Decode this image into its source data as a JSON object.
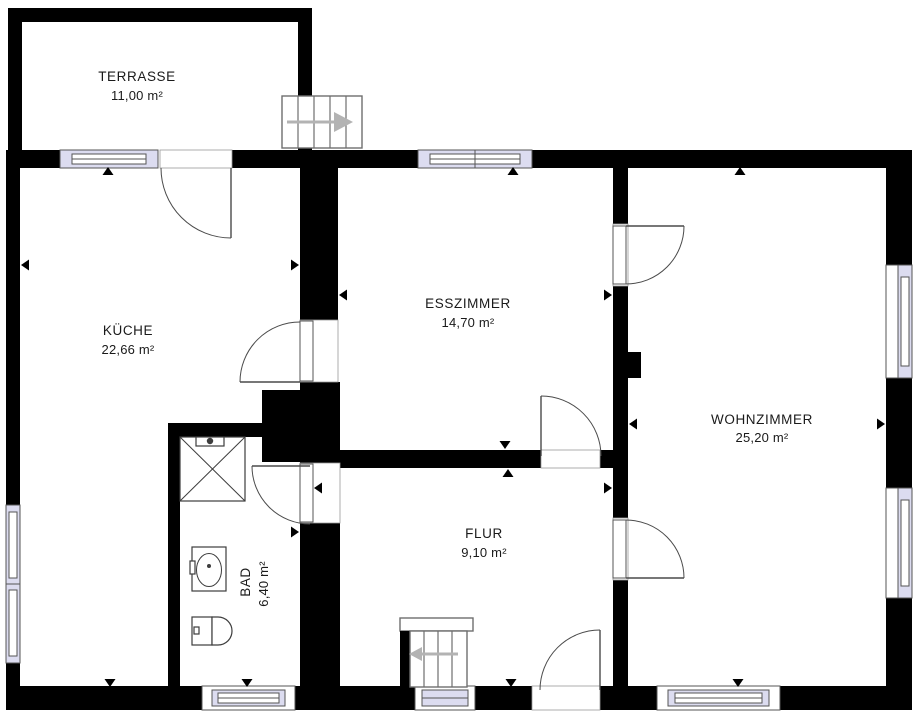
{
  "plan_title": "floor-plan",
  "rooms": {
    "terrasse": {
      "name": "TERRASSE",
      "area": "11,00 m²"
    },
    "kueche": {
      "name": "KÜCHE",
      "area": "22,66 m²"
    },
    "esszimmer": {
      "name": "ESSZIMMER",
      "area": "14,70 m²"
    },
    "wohnzimmer": {
      "name": "WOHNZIMMER",
      "area": "25,20 m²"
    },
    "flur": {
      "name": "FLUR",
      "area": "9,10 m²"
    },
    "bad": {
      "name": "BAD",
      "area": "6,40 m²"
    }
  },
  "colors": {
    "wall": "#000000",
    "window_fill": "#dcdcf0",
    "frame_line": "#555555",
    "stair_arrow": "#b3b3b3",
    "text": "#1a1a1a"
  }
}
